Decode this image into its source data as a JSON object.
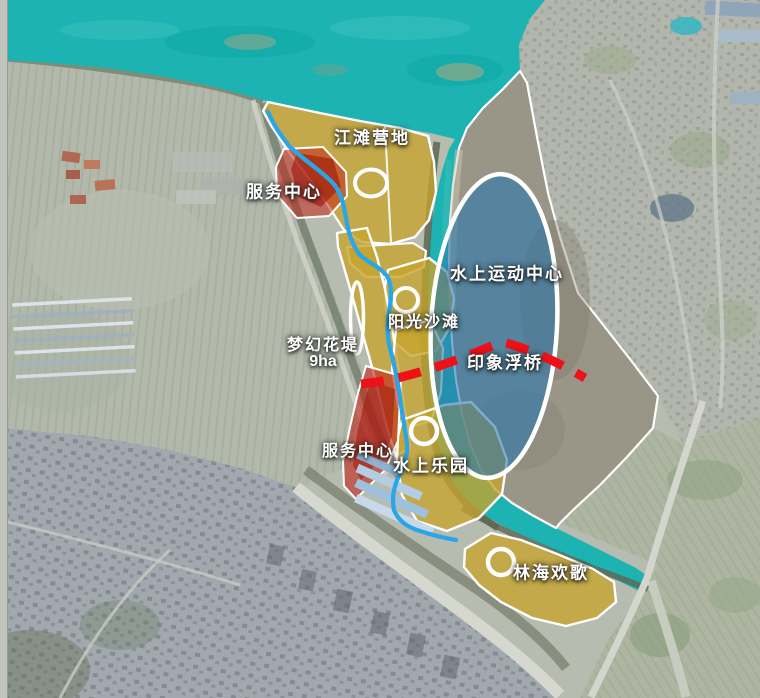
{
  "labels": {
    "riverside_camp": "江滩营地",
    "service_center_north": "服务中心",
    "water_sports_center": "水上运动中心",
    "sunshine_beach": "阳光沙滩",
    "dream_flower_dike": "梦幻花堤",
    "dream_flower_dike_area": "9ha",
    "impression_pontoon": "印象浮桥",
    "service_center_south": "服务中心",
    "water_park": "水上乐园",
    "forest_joy": "林海欢歌"
  },
  "colors": {
    "river_water": "#1cb3b2",
    "water_sports_fill": "#2a77ab",
    "parcel_yellow": "#c7a42c",
    "service_red": "#c2281a",
    "route_blue": "#2aa6e8",
    "pontoon_dash_red": "#ee1118",
    "marker_outline": "#ffffff",
    "sandbar_grey": "#8f897a"
  }
}
